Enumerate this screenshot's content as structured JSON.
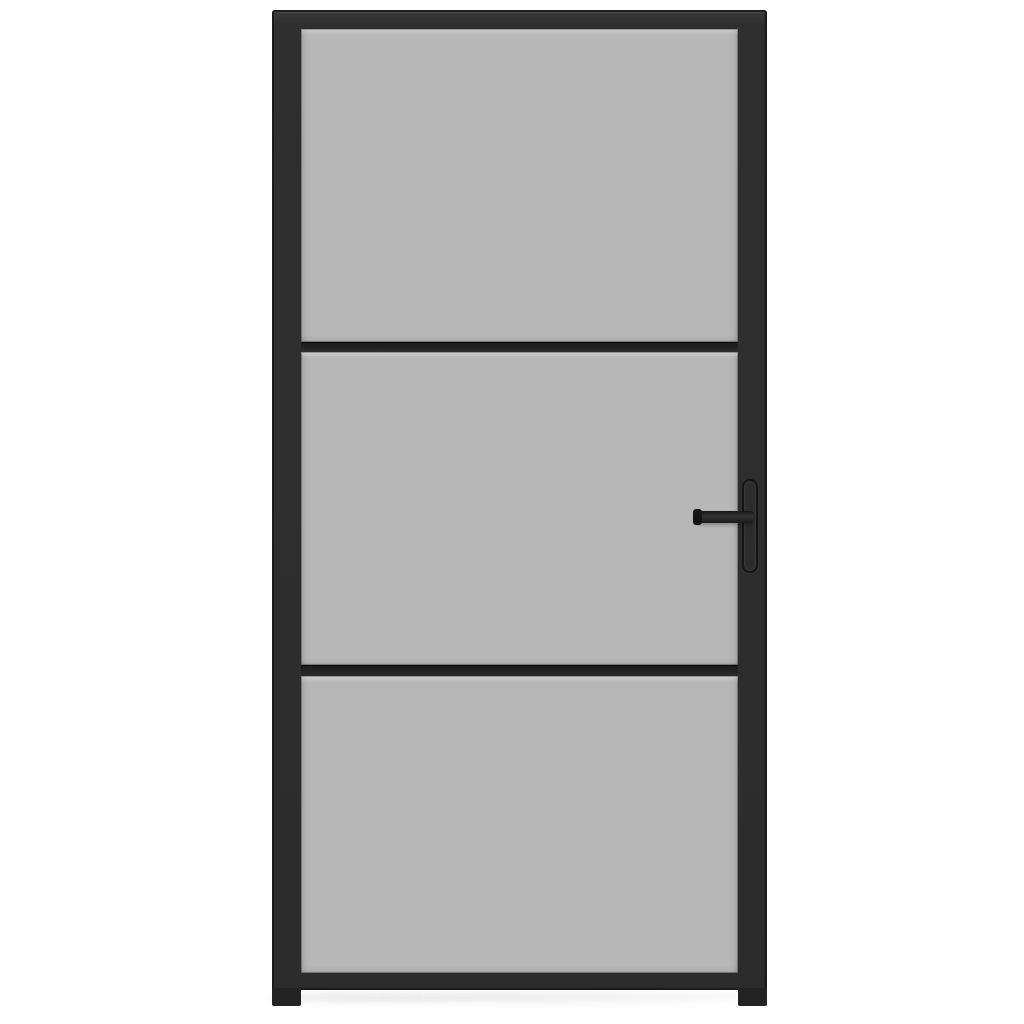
{
  "scene": {
    "label": "Interior door with black frame, three frosted grey glass panels and a lever handle on the right",
    "object": "interior-glass-door",
    "glass_panels": 3,
    "muntin_bars": 2,
    "handle_side": "right",
    "view": "front"
  },
  "colors": {
    "background": "#ffffff",
    "frame": "#2f2f2f",
    "frame_edge": "#1b1b1b",
    "glass": "#b7b7b7",
    "muntin_dark": "#191919",
    "muntin_light": "#2e2e2e",
    "handle_dark": "#141414",
    "handle_mid": "#2c2c2c"
  }
}
